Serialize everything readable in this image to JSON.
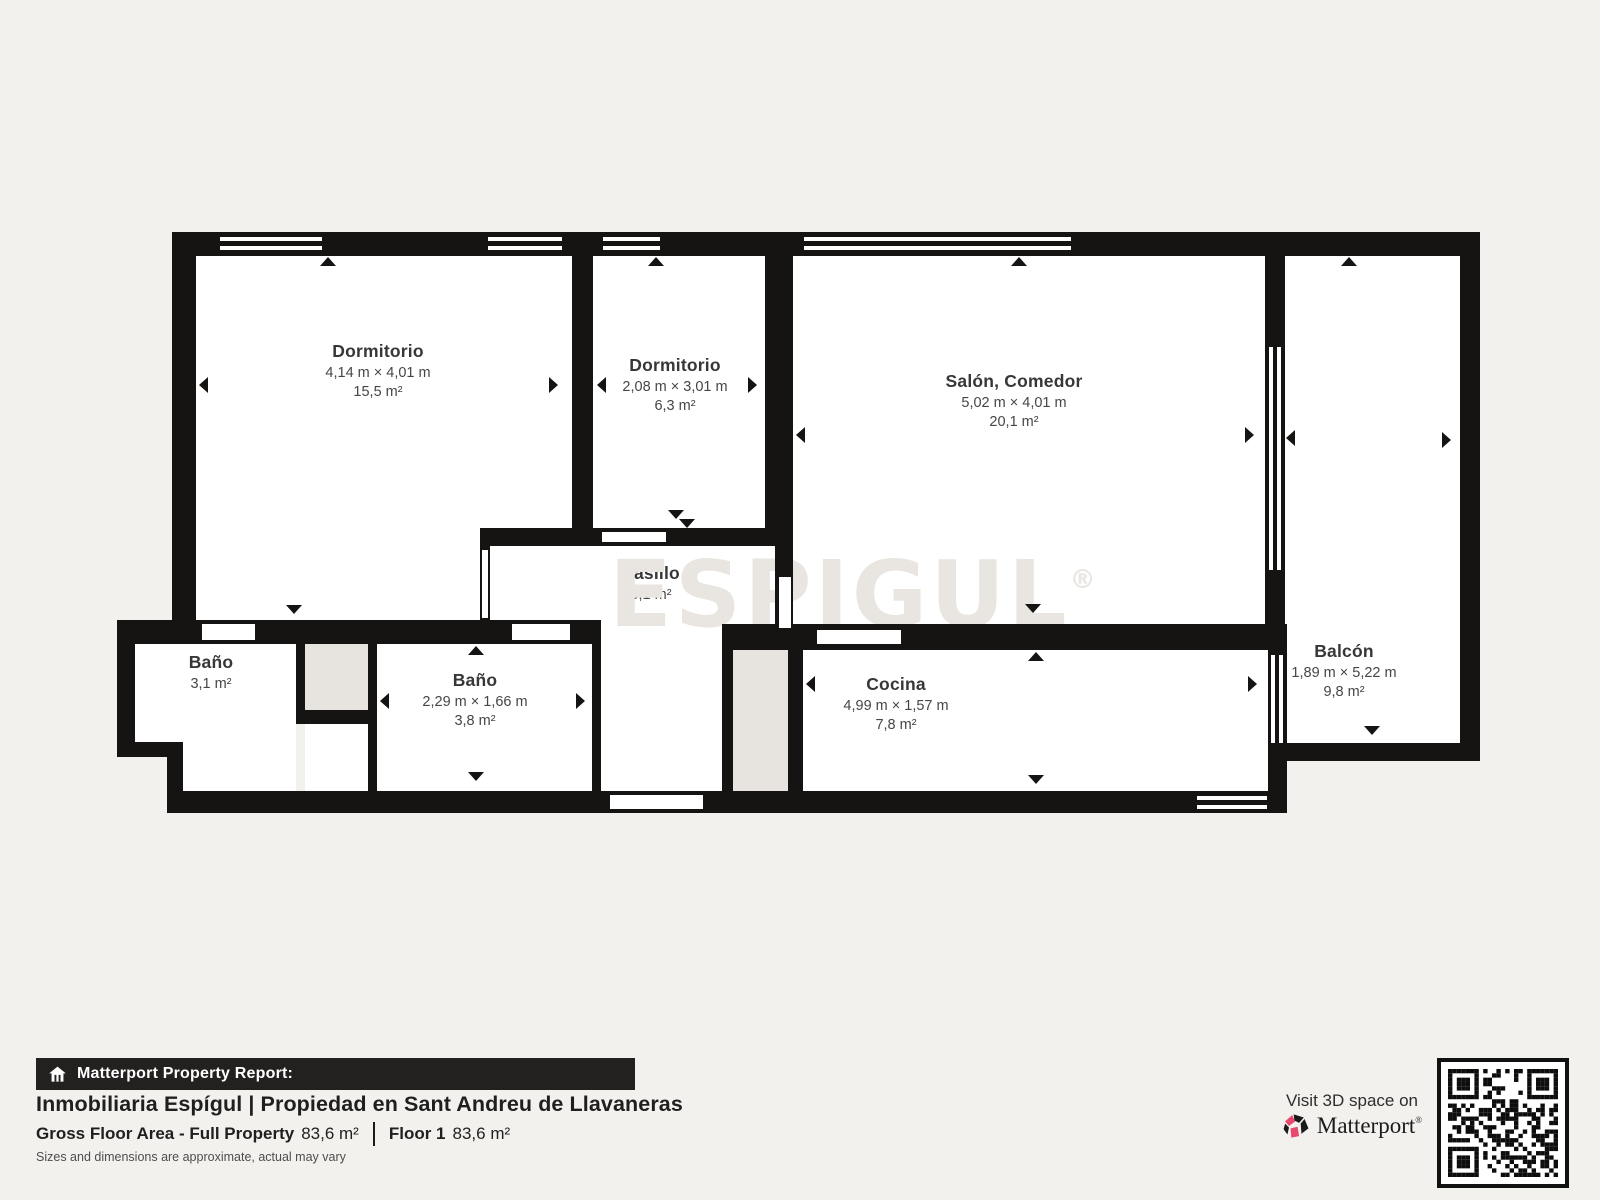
{
  "plan": {
    "rooms": {
      "dormitorio1": {
        "name": "Dormitorio",
        "dims": "4,14 m × 4,01 m",
        "area": "15,5 m²"
      },
      "dormitorio2": {
        "name": "Dormitorio",
        "dims": "2,08 m × 3,01 m",
        "area": "6,3 m²"
      },
      "salon": {
        "name": "Salón, Comedor",
        "dims": "5,02 m × 4,01 m",
        "area": "20,1 m²"
      },
      "balcon": {
        "name": "Balcón",
        "dims": "1,89 m × 5,22 m",
        "area": "9,8 m²"
      },
      "bano1": {
        "name": "Baño",
        "area": "3,1 m²"
      },
      "bano2": {
        "name": "Baño",
        "dims": "2,29 m × 1,66 m",
        "area": "3,8 m²"
      },
      "pasillo": {
        "name": "Pasillo",
        "area": "5,1 m²"
      },
      "cocina": {
        "name": "Cocina",
        "dims": "4,99 m × 1,57 m",
        "area": "7,8 m²"
      }
    },
    "watermark": {
      "text": "ESPIGUL",
      "reg": "®"
    }
  },
  "footer": {
    "report_bar_label": "Matterport Property Report:",
    "title": "Inmobiliaria Espígul | Propiedad en Sant Andreu de Llavaneras",
    "gross_label": "Gross Floor Area - Full Property",
    "gross_value": "83,6 m²",
    "floor_label": "Floor 1",
    "floor_value": "83,6 m²",
    "disclaimer": "Sizes and dimensions are approximate, actual may vary",
    "visit_text": "Visit 3D space on",
    "brand": "Matterport",
    "brand_reg": "®"
  },
  "icons": {
    "report_bar": "house-icon",
    "brand": "matterport-pinwheel-icon",
    "qr": "qr-code"
  },
  "colors": {
    "background": "#f3f1ee",
    "wall": "#161412",
    "room": "#ffffff",
    "shaft": "#e7e4e0",
    "bar_background": "#232120",
    "brand_pink": "#e8486b",
    "text_dark": "#1f1f1f"
  }
}
